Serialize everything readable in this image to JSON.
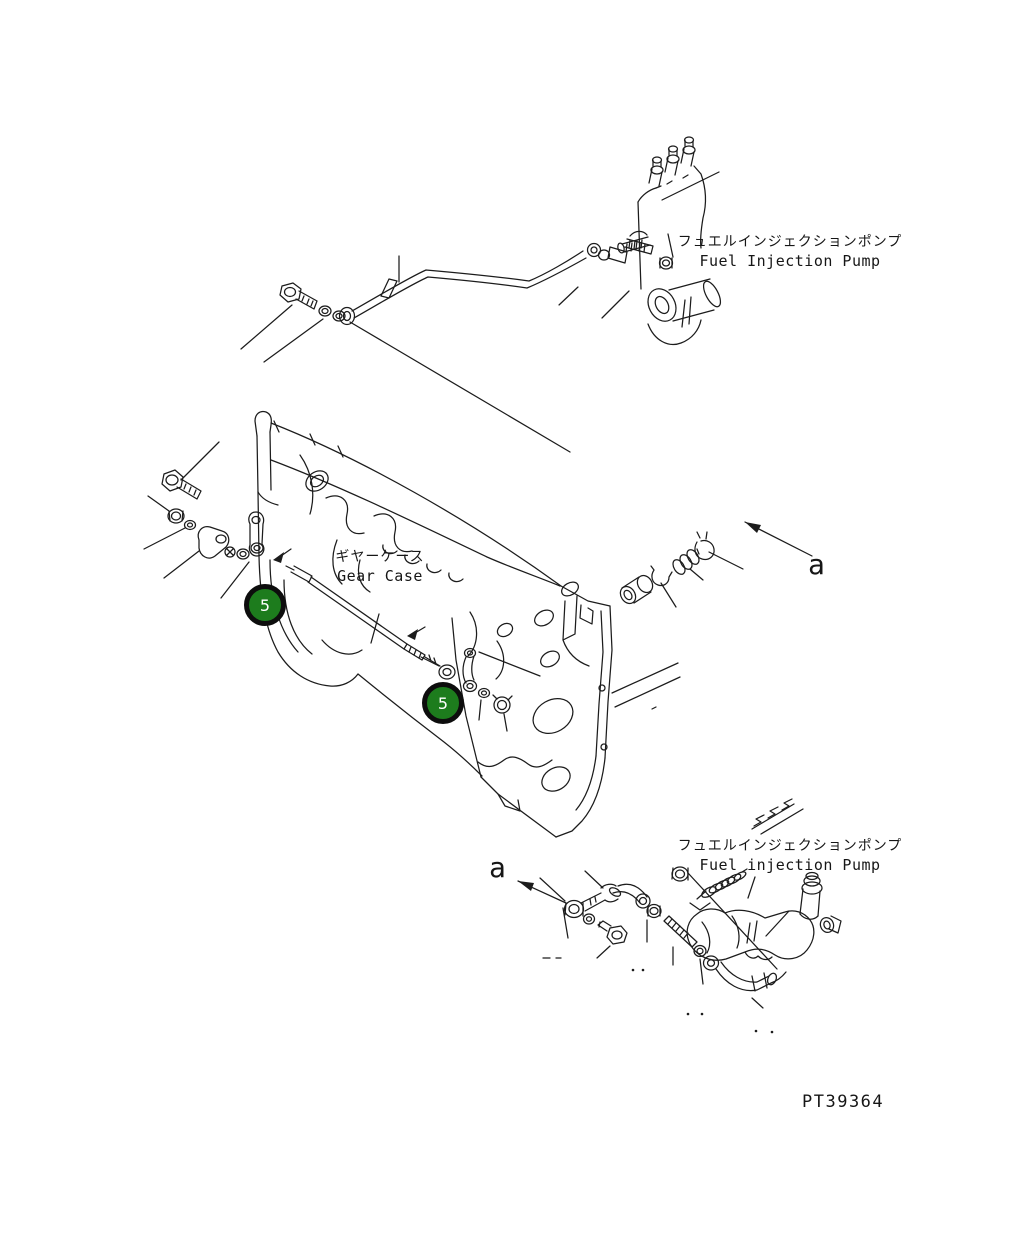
{
  "page": {
    "background": "#ffffff",
    "line_color": "#1c1c1c"
  },
  "drawing_number": "PT39364",
  "labels": {
    "top_pump": {
      "jp": "フュエルインジェクションポンプ",
      "en": "Fuel Injection Pump"
    },
    "gear_case": {
      "jp": "ギヤーケース",
      "en": "Gear Case"
    },
    "bottom_pump": {
      "jp": "フュエルインジェクションポンプ",
      "en": "Fuel injection Pump"
    }
  },
  "view_arrows": {
    "top": "a",
    "bottom": "a"
  },
  "callouts": [
    {
      "number": "5",
      "fill": "#1d7c1d",
      "ring": "#0d0d0d",
      "text_color": "#ffffff"
    },
    {
      "number": "5",
      "fill": "#1d7c1d",
      "ring": "#0d0d0d",
      "text_color": "#ffffff"
    }
  ]
}
